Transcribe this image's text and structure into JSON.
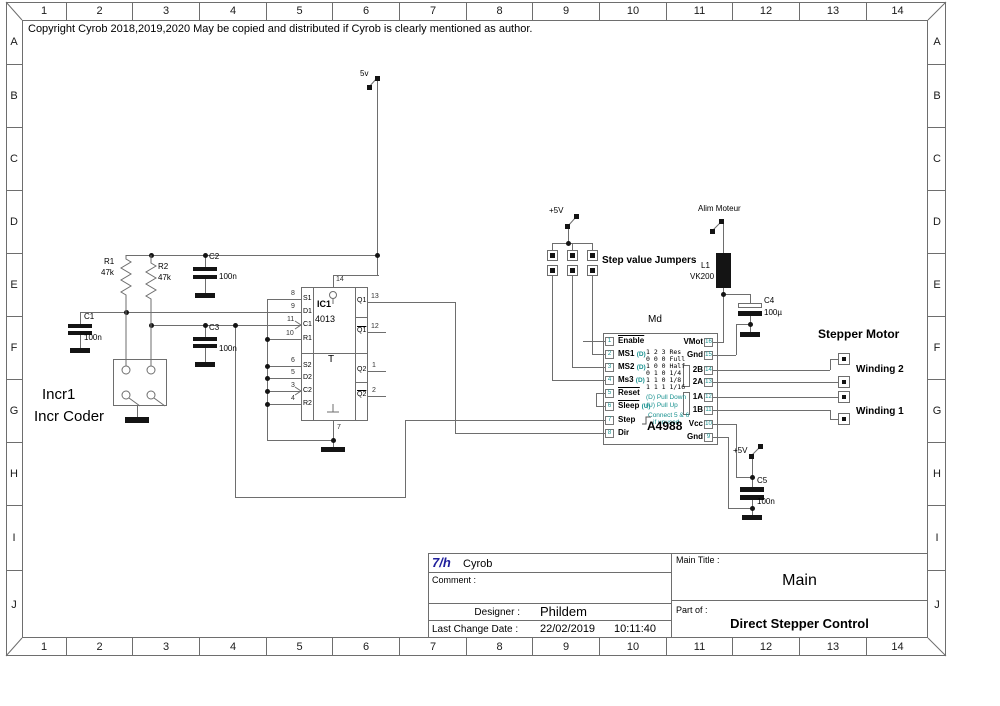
{
  "copyright": "Copyright Cyrob 2018,2019,2020 May be copied and distributed if Cyrob is clearly mentioned as author.",
  "frame": {
    "columns": [
      "1",
      "2",
      "3",
      "4",
      "5",
      "6",
      "7",
      "8",
      "9",
      "10",
      "11",
      "12",
      "13",
      "14"
    ],
    "rows": [
      "A",
      "B",
      "C",
      "D",
      "E",
      "F",
      "G",
      "H",
      "I",
      "J"
    ]
  },
  "power": {
    "v5": "5v",
    "p5v": "+5V",
    "alim": "Alim Moteur"
  },
  "encoder": {
    "ref": "Incr1",
    "label": "Incr Coder",
    "r1": "R1",
    "r1_val": "47k",
    "r2": "R2",
    "r2_val": "47k",
    "c1": "C1",
    "c1_val": "100n",
    "c2": "C2",
    "c2_val": "100n",
    "c3": "C3",
    "c3_val": "100n"
  },
  "ic1": {
    "ref": "IC1",
    "part": "4013",
    "center": "T",
    "pin_top": "14",
    "pin_bottom": "7",
    "left_pins": [
      {
        "n": "8",
        "l": "S1"
      },
      {
        "n": "9",
        "l": "D1"
      },
      {
        "n": "11",
        "l": "C1"
      },
      {
        "n": "10",
        "l": "R1"
      },
      {
        "n": "6",
        "l": "S2"
      },
      {
        "n": "5",
        "l": "D2"
      },
      {
        "n": "3",
        "l": "C2"
      },
      {
        "n": "4",
        "l": "R2"
      }
    ],
    "right_pins": [
      {
        "n": "13",
        "l": "Q1"
      },
      {
        "n": "12",
        "l": "Q1"
      },
      {
        "n": "1",
        "l": "Q2"
      },
      {
        "n": "2",
        "l": "Q2"
      }
    ]
  },
  "jumpers": {
    "label": "Step value Jumpers"
  },
  "driver": {
    "ref": "Md",
    "part": "A4988",
    "left_pins": [
      {
        "n": "1",
        "l": "Enable",
        "s": ""
      },
      {
        "n": "2",
        "l": "MS1",
        "s": "(D)"
      },
      {
        "n": "3",
        "l": "MS2",
        "s": "(D)"
      },
      {
        "n": "4",
        "l": "Ms3",
        "s": "(D)"
      },
      {
        "n": "5",
        "l": "Reset",
        "s": ""
      },
      {
        "n": "6",
        "l": "Sleep",
        "s": "(U)"
      },
      {
        "n": "7",
        "l": "Step",
        "s": ""
      },
      {
        "n": "8",
        "l": "Dir",
        "s": ""
      }
    ],
    "right_pins": [
      {
        "n": "16",
        "l": "VMot"
      },
      {
        "n": "15",
        "l": "Gnd"
      },
      {
        "n": "14",
        "l": "2B"
      },
      {
        "n": "13",
        "l": "2A"
      },
      {
        "n": "12",
        "l": "1A"
      },
      {
        "n": "11",
        "l": "1B"
      },
      {
        "n": "10",
        "l": "Vcc"
      },
      {
        "n": "9",
        "l": "Gnd"
      }
    ],
    "table": [
      "1 2 3 Res",
      "0 0 0 Full",
      "1 0 0 Half",
      "0 1 0 1/4",
      "1 1 0 1/8",
      "1 1 1 1/16"
    ],
    "note_d": "(D) Pull Down",
    "note_u": "(U) Pull Up",
    "note_c1": "Connect 5 & 6",
    "note_c2": "if unused"
  },
  "motor": {
    "title": "Stepper Motor",
    "winding2": "Winding 2",
    "winding1": "Winding 1",
    "l1": "L1",
    "l1_val": "VK200",
    "c4": "C4",
    "c4_val": "100µ",
    "c5": "C5",
    "c5_val": "100n"
  },
  "titleblock": {
    "logo": "7/h",
    "company": "Cyrob",
    "comment_label": "Comment :",
    "designer_label": "Designer :",
    "designer": "Phildem",
    "date_label": "Last Change Date :",
    "date": "22/02/2019",
    "time": "10:11:40",
    "main_title_label": "Main Title :",
    "main_title": "Main",
    "part_of_label": "Part of :",
    "part_of": "Direct Stepper Control"
  }
}
